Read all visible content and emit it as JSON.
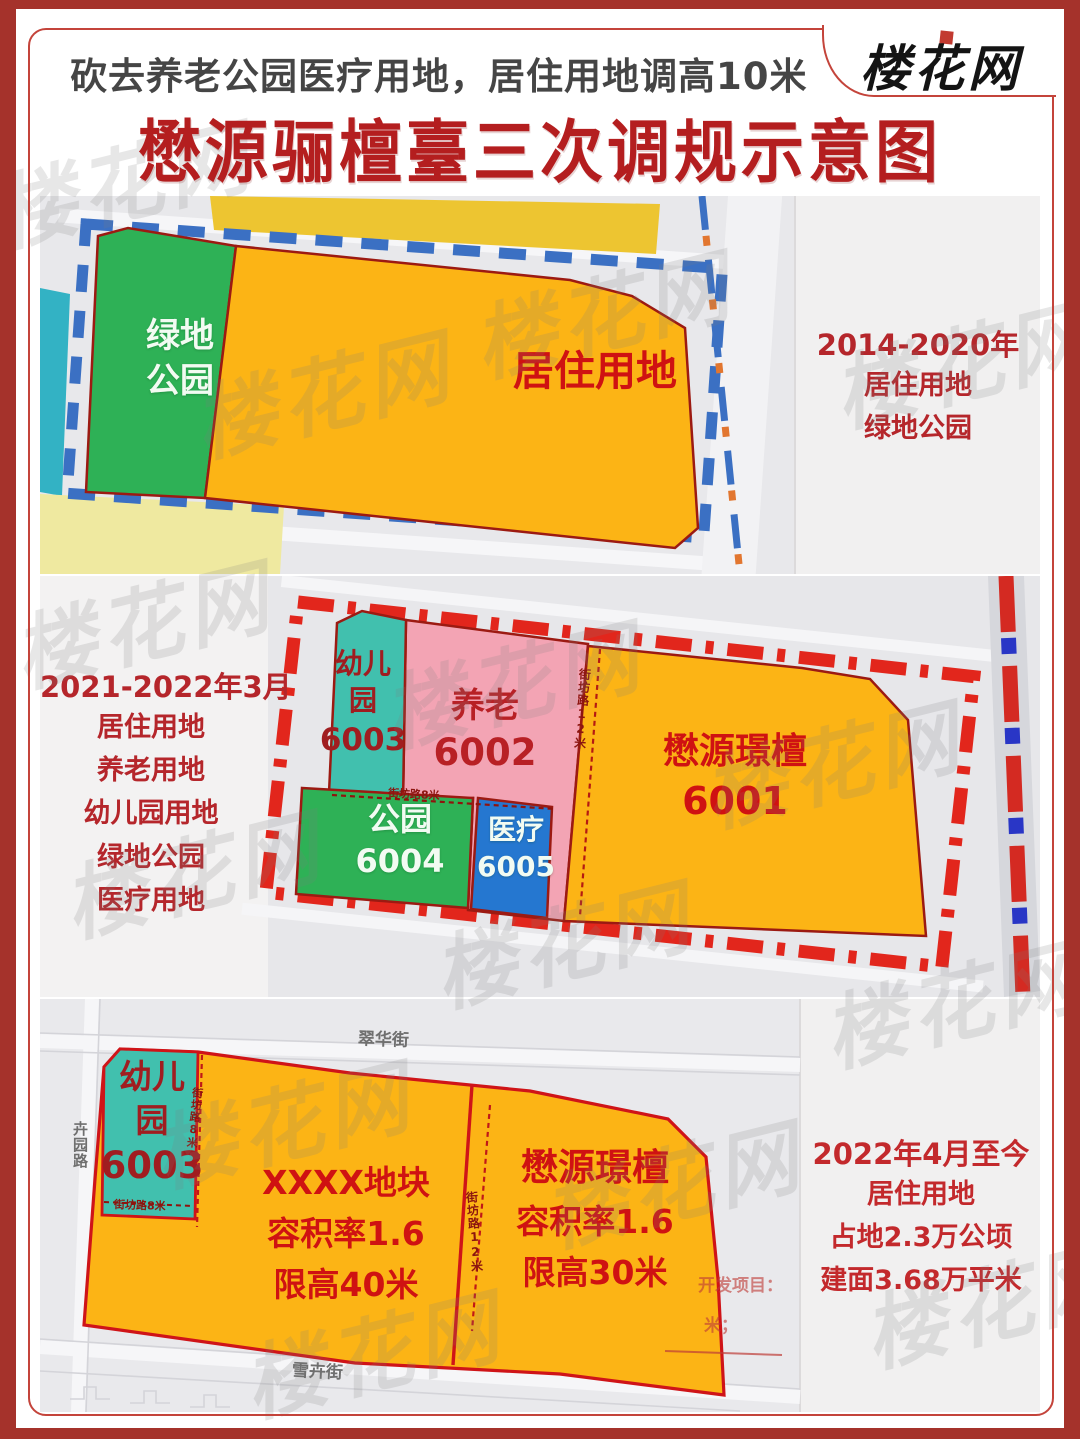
{
  "header": {
    "banner": "砍去养老公园医疗用地，居住用地调高10米",
    "title": "懋源骊檀臺三次调规示意图",
    "logo": "楼花网"
  },
  "watermark": {
    "text": "楼花网"
  },
  "panel1": {
    "note": {
      "period": "2014-2020年",
      "line1": "居住用地",
      "line2": "绿地公园"
    },
    "green_plot": {
      "line1": "绿地",
      "line2": "公园"
    },
    "residential_label": "居住用地"
  },
  "panel2": {
    "note": {
      "period": "2021-2022年3月",
      "line1": "居住用地",
      "line2": "养老用地",
      "line3": "幼儿园用地",
      "line4": "绿地公园",
      "line5": "医疗用地"
    },
    "kindergarten": {
      "line1": "幼儿",
      "line2": "园",
      "code": "6003"
    },
    "elder": {
      "name": "养老",
      "code": "6002"
    },
    "park": {
      "name": "公园",
      "code": "6004"
    },
    "medical": {
      "name": "医疗",
      "code": "6005"
    },
    "main_plot": {
      "name": "懋源璟檀",
      "code": "6001"
    },
    "road8": "街坊路8米",
    "road12": "街坊路12米"
  },
  "panel3": {
    "note": {
      "period": "2022年4月至今",
      "line1": "居住用地",
      "line2": "占地2.3万公顷",
      "line3": "建面3.68万平米"
    },
    "kindergarten": {
      "line1": "幼儿",
      "line2": "园",
      "code": "6003"
    },
    "left_plot": {
      "name": "XXXX地块",
      "far": "容积率1.6",
      "height": "限高40米"
    },
    "right_plot": {
      "name": "懋源璟檀",
      "far": "容积率1.6",
      "height": "限高30米"
    },
    "streets": {
      "top": "翠华街",
      "left": "卉园路",
      "bottom": "雪卉街"
    },
    "road8_v": "街坊路8米",
    "road8_h": "街坊路8米",
    "road12": "街坊路12米",
    "annotation1": "开发项目：",
    "annotation2": "米；"
  }
}
